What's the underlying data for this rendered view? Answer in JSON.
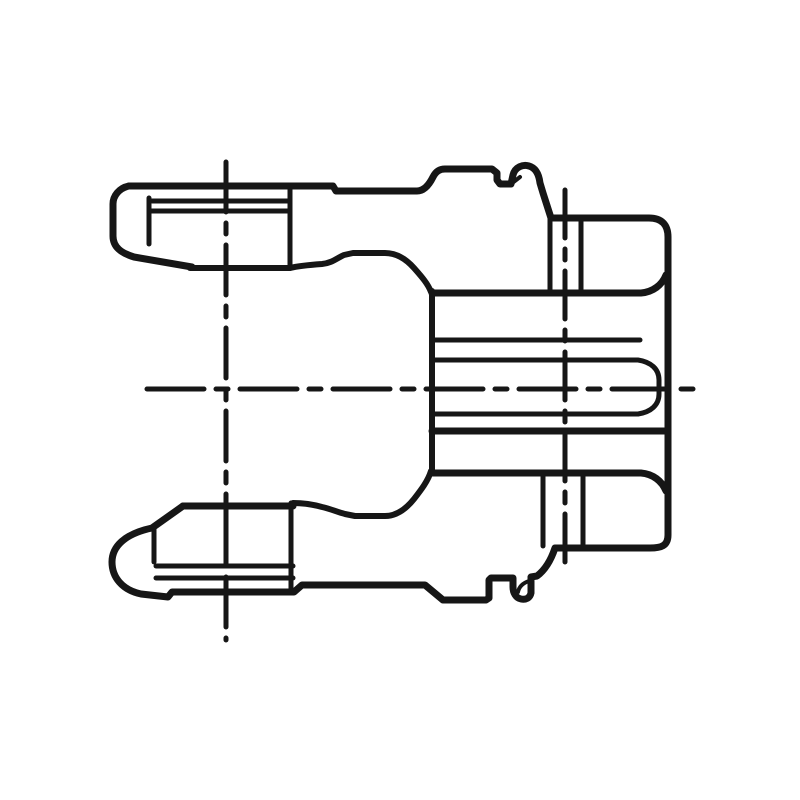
{
  "drawing": {
    "background": "#ffffff",
    "ink": "#161616",
    "paths": [
      {
        "name": "outer-silhouette",
        "w": 7,
        "dash": "none",
        "d": "M 129 186 L 333 186 L 336 191 L 417 191 C 424 191 429 185 433 177 C 436 171 440 169 445 169 L 492 169 L 497 173 L 497 180 L 500 184 L 511 184 L 513 175 C 515 167 523 164 529 166 C 536 168 539 175 540 183 L 543 193 L 551 218 L 649 218 C 662 218 668 225 668 237 L 668 535 C 668 546 661 548 650 548 L 555 548 C 551 560 545 570 537 576 L 531 577 L 531 593 C 530 598 526 600 521 599 C 516 598 513 593 513 587 L 513 578 L 491 578 L 489 580 L 489 598 L 486 600 L 443 600 L 425 585 L 302 585 L 294 592 L 172 592 L 168 597 L 141 594 C 122 590 112 577 112 562 C 112 547 124 534 152 528 L 183 506"
      },
      {
        "name": "top-ear-ball-end",
        "w": 7,
        "dash": "none",
        "d": "M 129 186 C 119 188 113 196 113 204 L 113 236 C 113 247 121 253 134 257 L 192 267"
      },
      {
        "name": "top-ear-bottom-line",
        "w": 6,
        "dash": "none",
        "d": "M 190 268 L 290 268"
      },
      {
        "name": "top-ear-right-vertical",
        "w": 5,
        "dash": "none",
        "d": "M 290 187 L 290 268"
      },
      {
        "name": "top-ear-groove-line-1",
        "w": 5,
        "dash": "none",
        "d": "M 152 201 L 290 201"
      },
      {
        "name": "top-ear-groove-line-2",
        "w": 5,
        "dash": "none",
        "d": "M 151 211 L 290 211"
      },
      {
        "name": "top-ear-ball-joint-vertical",
        "w": 5,
        "dash": "none",
        "d": "M 149 198 L 149 244"
      },
      {
        "name": "top-saddle-contour",
        "w": 6,
        "dash": "none",
        "d": "M 290 268 C 298 266 308 265 322 264 C 332 263 337 258 344 255 L 353 253 L 385 253 C 396 253 406 259 414 268 C 422 277 428 284 431 292"
      },
      {
        "name": "bottom-ear-top-line",
        "w": 7,
        "dash": "none",
        "d": "M 183 506 L 293 506"
      },
      {
        "name": "bottom-ear-right-vertical",
        "w": 5,
        "dash": "none",
        "d": "M 291 503 L 291 592"
      },
      {
        "name": "bottom-ear-mid-vertical",
        "w": 5,
        "dash": "none",
        "d": "M 226 508 L 226 562"
      },
      {
        "name": "bottom-ear-left-vertical",
        "w": 5,
        "dash": "none",
        "d": "M 154 528 L 154 562"
      },
      {
        "name": "bottom-ear-groove-line-1",
        "w": 5,
        "dash": "none",
        "d": "M 156 566 L 293 566"
      },
      {
        "name": "bottom-ear-groove-line-2",
        "w": 5,
        "dash": "none",
        "d": "M 156 578 L 293 578"
      },
      {
        "name": "bottom-saddle-contour",
        "w": 6,
        "dash": "none",
        "d": "M 293 503 C 305 503 315 505 322 507 C 331 509 337 512 345 514 L 355 516 L 385 516 C 396 516 406 509 414 499 C 421 490 428 481 431 471"
      },
      {
        "name": "hub-left-edge",
        "w": 6,
        "dash": "none",
        "d": "M 432 291 L 432 471"
      },
      {
        "name": "hub-top-line",
        "w": 7,
        "dash": "none",
        "d": "M 432 293 L 641 293 C 653 292 662 285 666 275"
      },
      {
        "name": "bore-upper-major-line",
        "w": 5,
        "dash": "none",
        "d": "M 432 340 L 640 340"
      },
      {
        "name": "bore-upper-minor-line-with-chamfer",
        "w": 5,
        "dash": "none",
        "d": "M 432 360 L 638 360 C 651 362 659 369 659 380 L 659 394 C 659 405 651 412 638 414"
      },
      {
        "name": "bore-lower-minor-line",
        "w": 5,
        "dash": "none",
        "d": "M 432 414 L 638 414"
      },
      {
        "name": "bore-lower-major-line",
        "w": 7,
        "dash": "none",
        "d": "M 432 431 L 665 431"
      },
      {
        "name": "hub-bottom-line",
        "w": 7,
        "dash": "none",
        "d": "M 432 473 L 641 473 C 653 474 662 481 666 491"
      },
      {
        "name": "cross-hole-top-left-wall",
        "w": 5,
        "dash": "none",
        "d": "M 550 219 L 550 291"
      },
      {
        "name": "cross-hole-top-right-wall",
        "w": 5,
        "dash": "none",
        "d": "M 581 219 L 581 291"
      },
      {
        "name": "cross-hole-bottom-left-wall",
        "w": 5,
        "dash": "none",
        "d": "M 543 474 L 543 546"
      },
      {
        "name": "cross-hole-bottom-right-wall",
        "w": 5,
        "dash": "none",
        "d": "M 583 474 L 583 546"
      },
      {
        "name": "pin-button-notch",
        "w": 4,
        "dash": "none",
        "d": "M 511 184 L 520 177"
      },
      {
        "name": "bottom-tab-notch",
        "w": 4,
        "dash": "none",
        "d": "M 529 581 C 523 583 519 587 518 592"
      },
      {
        "name": "centerline-horizontal-axis",
        "w": 5,
        "dash": "57 12 12 12",
        "d": "M 147 389 L 694 389"
      },
      {
        "name": "centerline-vertical-ear-axis",
        "w": 5,
        "dash": "50 11 11 11",
        "d": "M 226 162 L 226 640"
      },
      {
        "name": "centerline-vertical-hole-axis",
        "w": 5,
        "dash": "48 11 11 11",
        "d": "M 565 190 L 565 572"
      }
    ]
  }
}
